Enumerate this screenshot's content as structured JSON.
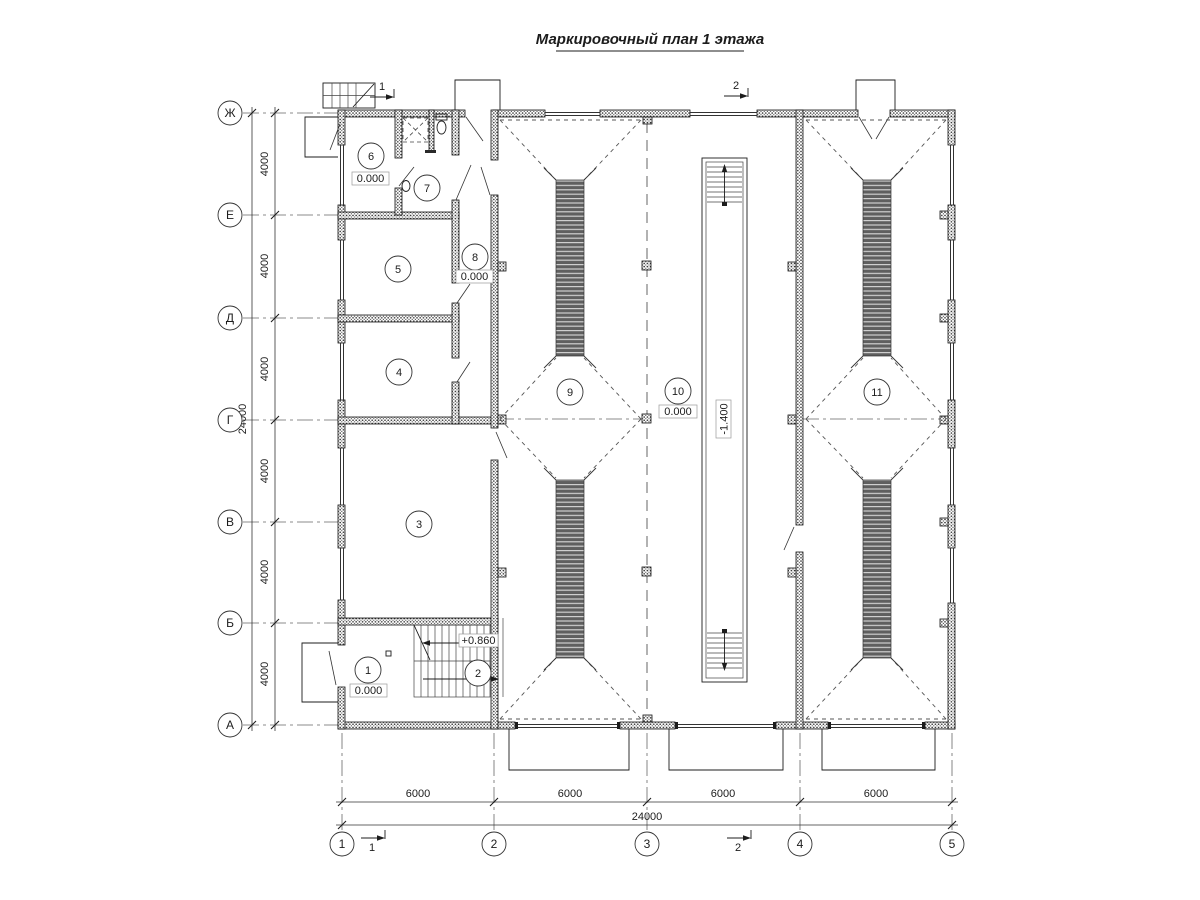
{
  "title": "Маркировочный план 1 этажа",
  "grid": {
    "rows": [
      "Ж",
      "Е",
      "Д",
      "Г",
      "В",
      "Б",
      "А"
    ],
    "cols": [
      "1",
      "2",
      "3",
      "4",
      "5"
    ],
    "row_dims": [
      "4000",
      "4000",
      "4000",
      "4000",
      "4000",
      "4000"
    ],
    "row_total": "24000",
    "col_dims": [
      "6000",
      "6000",
      "6000",
      "6000"
    ],
    "col_total": "24000"
  },
  "rooms": {
    "r1": {
      "number": "1",
      "elevation": "0.000"
    },
    "r2": {
      "number": "2",
      "elevation": "+0.860"
    },
    "r3": {
      "number": "3"
    },
    "r4": {
      "number": "4"
    },
    "r5": {
      "number": "5"
    },
    "r6": {
      "number": "6",
      "elevation": "0.000"
    },
    "r7": {
      "number": "7"
    },
    "r8": {
      "number": "8",
      "elevation": "0.000"
    },
    "r9": {
      "number": "9"
    },
    "r10": {
      "number": "10",
      "elevation": "0.000"
    },
    "r11": {
      "number": "11"
    }
  },
  "pit": {
    "elevation": "-1.400"
  },
  "section_marks": {
    "s1": "1",
    "s2": "2"
  },
  "colors": {
    "paper": "#ffffff",
    "ink": "#1c1c1c",
    "dash_line": "#555555",
    "strip_dark": "#5f5f5f",
    "strip_light": "#d0d0d0"
  }
}
